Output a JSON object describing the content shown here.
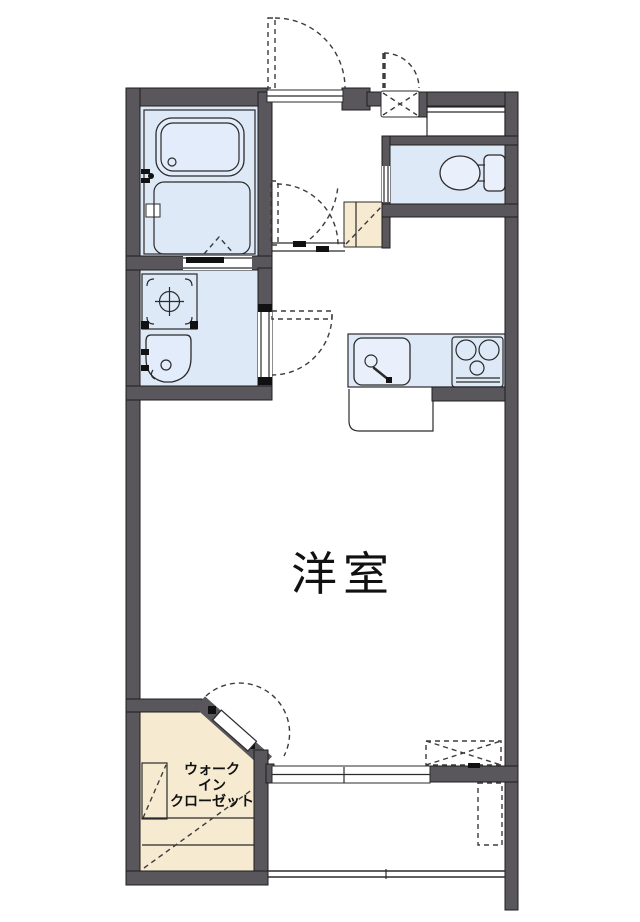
{
  "labels": {
    "living_room": "洋室",
    "closet_line1": "ウォーク",
    "closet_line2": "イン",
    "closet_line3": "クローゼット"
  },
  "colors": {
    "wall": "#59565c",
    "water_area_floor": "#dde9f7",
    "closet_floor": "#f6ebd1",
    "outline": "#2b2b2b",
    "background": "#ffffff"
  },
  "rooms": [
    "bathroom",
    "washroom",
    "entrance-hall",
    "toilet",
    "kitchen",
    "western-room",
    "walk-in-closet",
    "balcony"
  ],
  "fixtures": [
    "bathtub",
    "shower-floor",
    "washing-machine-pan",
    "washbasin",
    "toilet",
    "kitchen-sink",
    "gas-stove",
    "shoe-cabinet",
    "meter-box",
    "air-conditioner",
    "ac-outdoor-unit",
    "sliding-window",
    "entrance-door",
    "balcony-railing"
  ]
}
